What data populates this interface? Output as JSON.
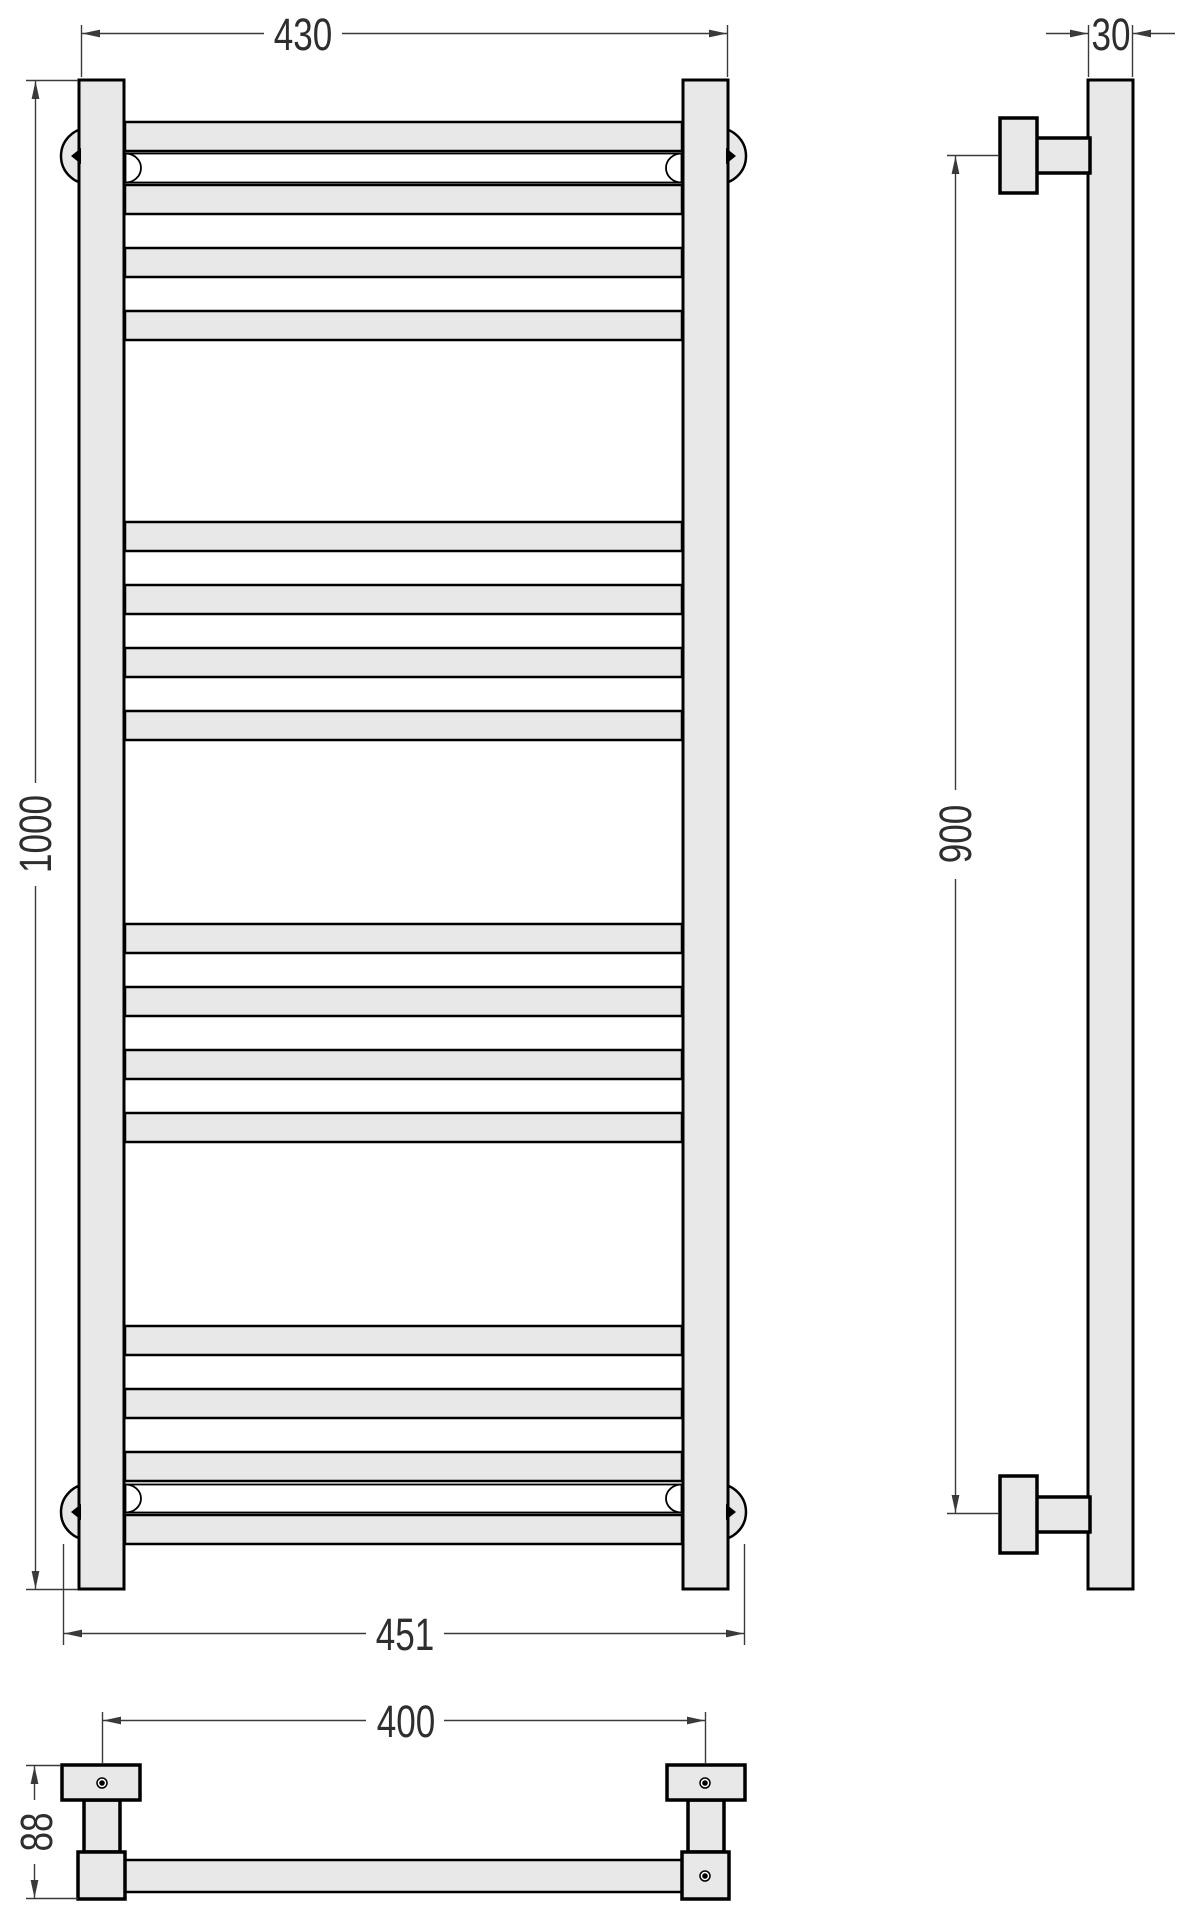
{
  "drawing": {
    "dimensions": {
      "top_width": "430",
      "height": "1000",
      "bottom_width": "451",
      "depth": "30",
      "mount_height": "900",
      "mount_width": "400",
      "bracket_height": "88"
    },
    "colors": {
      "metal_fill": "#e8e8e8",
      "outline": "#000000",
      "dimension_line": "#3a3a3a",
      "background": "#ffffff"
    }
  }
}
